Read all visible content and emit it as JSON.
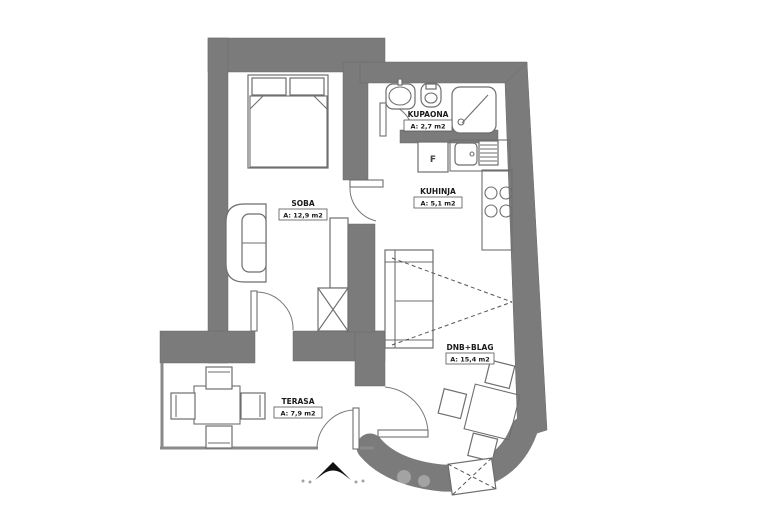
{
  "floorplan": {
    "rooms": [
      {
        "name": "SOBA",
        "area": "A: 12,9 m2"
      },
      {
        "name": "KUPAONA",
        "area": "A: 2,7 m2"
      },
      {
        "name": "KUHINJA",
        "area": "A: 5,1 m2"
      },
      {
        "name": "DNB+BLAG",
        "area": "A: 15,4 m2"
      },
      {
        "name": "TERASA",
        "area": "A: 7,9 m2"
      }
    ],
    "kitchen": {
      "fridge_label": "F"
    },
    "colors": {
      "wall": "#7b7b7b",
      "line": "#6e6e6e",
      "text": "#1a1a1a",
      "background": "#ffffff",
      "watermark": "#111111"
    }
  }
}
